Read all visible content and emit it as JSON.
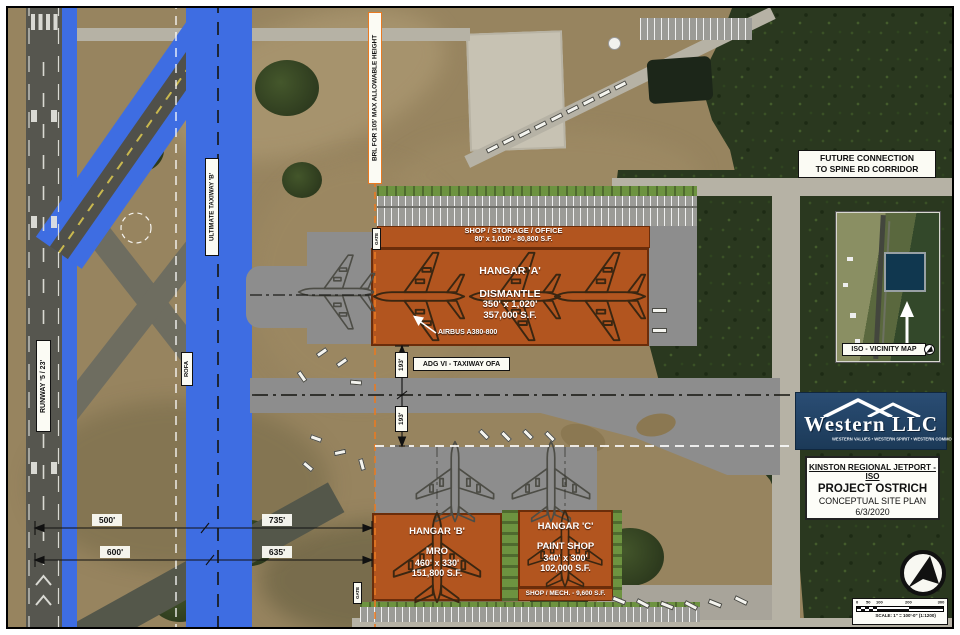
{
  "plan": {
    "labels": {
      "runway": "RUNWAY '5 / 23'",
      "ultimate_taxiway": "ULTIMATE TAXIWAY 'B'",
      "rofa": "ROFA",
      "brl": "BRL FOR 105' MAX ALLOWABLE HEIGHT",
      "adg_taxiway": "ADG VI - TAXIWAY OFA",
      "airbus": "AIRBUS A380-800",
      "future_connection_line1": "FUTURE CONNECTION",
      "future_connection_line2": "TO SPINE RD CORRIDOR",
      "gate": "GATE"
    },
    "buildings": {
      "shop_storage": {
        "line1": "SHOP / STORAGE / OFFICE",
        "line2": "80' x 1,010' - 80,800 S.F."
      },
      "hangar_a": {
        "name": "HANGAR 'A'",
        "use": "DISMANTLE",
        "dims": "350' x 1,020'",
        "area": "357,000 S.F."
      },
      "hangar_b": {
        "name": "HANGAR 'B'",
        "use": "MRO",
        "dims": "460' x 330'",
        "area": "151,800 S.F."
      },
      "hangar_c": {
        "name": "HANGAR 'C'",
        "use": "PAINT SHOP",
        "dims": "340' x 300'",
        "area": "102,000 S.F."
      },
      "shop_mech": "SHOP / MECH. - 9,600 S.F."
    },
    "dimensions": {
      "d500": "500'",
      "d735": "735'",
      "d600": "600'",
      "d635": "635'",
      "d193_north": "193'",
      "d193_south": "193'"
    }
  },
  "sidebar": {
    "vicinity_map": {
      "label": "ISO - VICINITY MAP"
    },
    "logo": {
      "name": "Western LLC",
      "tagline": "WESTERN VALUES  •  WESTERN SPIRIT  •  WESTERN COMMON SENSE"
    },
    "title_block": {
      "project_line1": "KINSTON REGIONAL JETPORT - ISO",
      "project_line2": "PROJECT OSTRICH",
      "project_line3": "CONCEPTUAL SITE PLAN",
      "date": "6/3/2020"
    },
    "scale_bar": {
      "ticks": [
        "0",
        "50",
        "100",
        "200",
        "300"
      ],
      "text": "SCALE: 1\" = 100'-0\" (1:1200)"
    }
  },
  "colors": {
    "building_orange": "#b2551f",
    "taxiway_blue": "#3e6de2",
    "apron_gray": "#8d8d8d",
    "brl_orange": "#e87a22",
    "forest_green": "#2a381f",
    "field_tan": "#97845f",
    "logo_navy": "#1d3a58"
  }
}
